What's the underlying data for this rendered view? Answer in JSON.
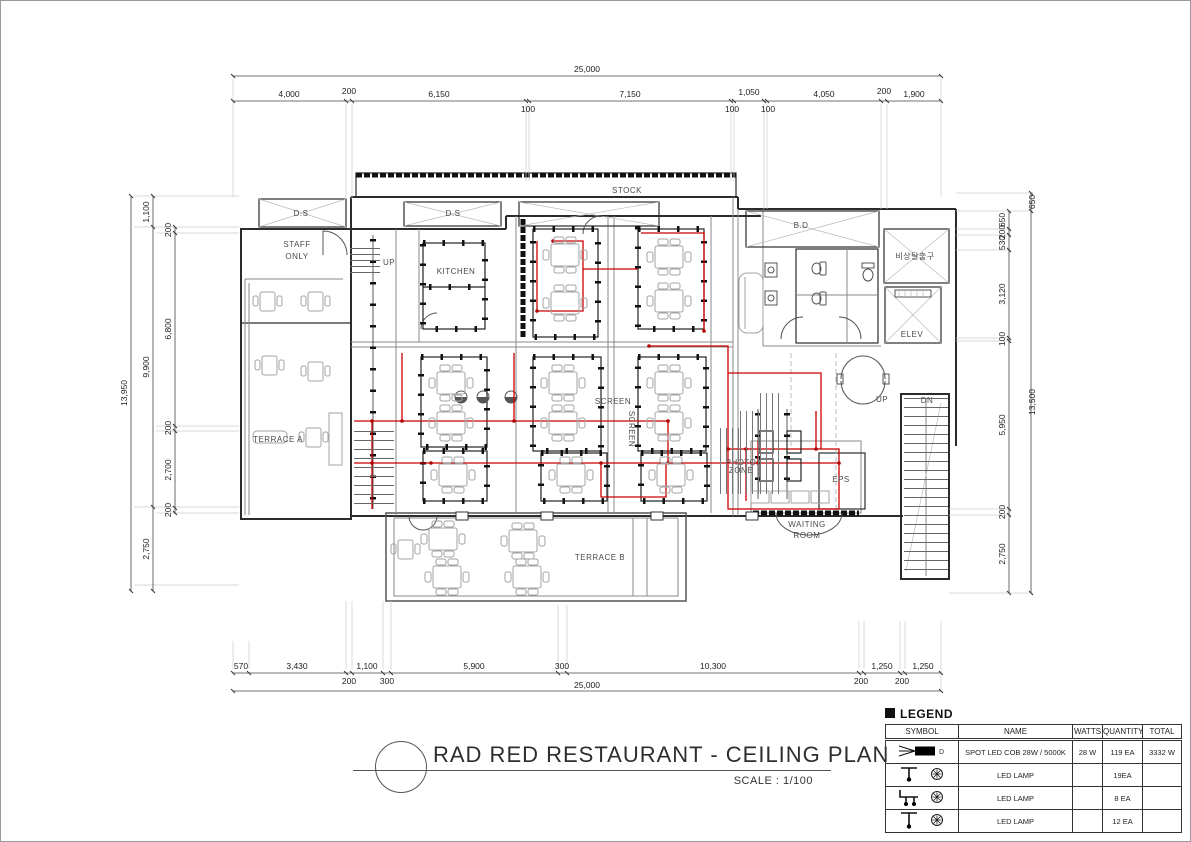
{
  "drawing": {
    "title": "RAD RED RESTAURANT - CEILING PLAN",
    "scale": "SCALE : 1/100"
  },
  "colors": {
    "wall": "#2b2b2b",
    "partition": "#888888",
    "wiring": "#cc0000",
    "furniture": "#a3a3a3",
    "dimension": "#333333",
    "background": "#ffffff"
  },
  "labels": {
    "stock": "STOCK",
    "staff1": "STAFF",
    "staff2": "ONLY",
    "kitchen": "KITCHEN",
    "up": "UP",
    "up2": "UP",
    "dn": "DN",
    "terrace_a": "TERRACE A",
    "terrace_b": "TERRACE B",
    "screen_h": "SCREEN",
    "screen_v": "SCREEN",
    "photo1": "PHOTO",
    "photo2": "ZONE",
    "eps": "EPS",
    "waiting1": "WAITING",
    "waiting2": "ROOM",
    "elev": "ELEV",
    "emergency_exit": "비상탈출구",
    "duct1": "D.S",
    "duct2": "D.S",
    "duct3": "B.D"
  },
  "dims": {
    "top_total": "25,000",
    "top": [
      "4,000",
      "200",
      "6,150",
      "100",
      "7,150",
      "100",
      "1,050",
      "100",
      "4,050",
      "200",
      "1,900"
    ],
    "bottom": [
      "570",
      "3,430",
      "200",
      "1,100",
      "300",
      "5,900",
      "300",
      "10,300",
      "200",
      "1,250",
      "200",
      "1,250"
    ],
    "bottom_total": "25,000",
    "left_outer": "13,950",
    "left_mid": [
      "1,100",
      "9,900",
      "2,750"
    ],
    "left_inner": [
      "200",
      "6,800",
      "200",
      "2,700",
      "200"
    ],
    "right_inner": [
      "650",
      "200",
      "530",
      "3,120",
      "100",
      "5,950",
      "200",
      "2,750"
    ],
    "right_outer": [
      "650",
      "13,500"
    ]
  },
  "legend": {
    "heading": "LEGEND",
    "spot_tag": "D",
    "columns": [
      "SYMBOL",
      "NAME",
      "WATTS",
      "QUANTITY",
      "TOTAL"
    ],
    "rows": [
      {
        "symbol": "spot-led-icon",
        "name": "SPOT LED COB 28W / 5000K",
        "watts": "28 W",
        "quantity": "119 EA",
        "total": "3332 W"
      },
      {
        "symbol": "led-lamp-pendant-icon",
        "name": "LED LAMP",
        "watts": "",
        "quantity": "19EA",
        "total": ""
      },
      {
        "symbol": "led-lamp-branched-icon",
        "name": "LED LAMP",
        "watts": "",
        "quantity": "8 EA",
        "total": ""
      },
      {
        "symbol": "led-lamp-drop-icon",
        "name": "LED LAMP",
        "watts": "",
        "quantity": "12 EA",
        "total": ""
      }
    ]
  }
}
